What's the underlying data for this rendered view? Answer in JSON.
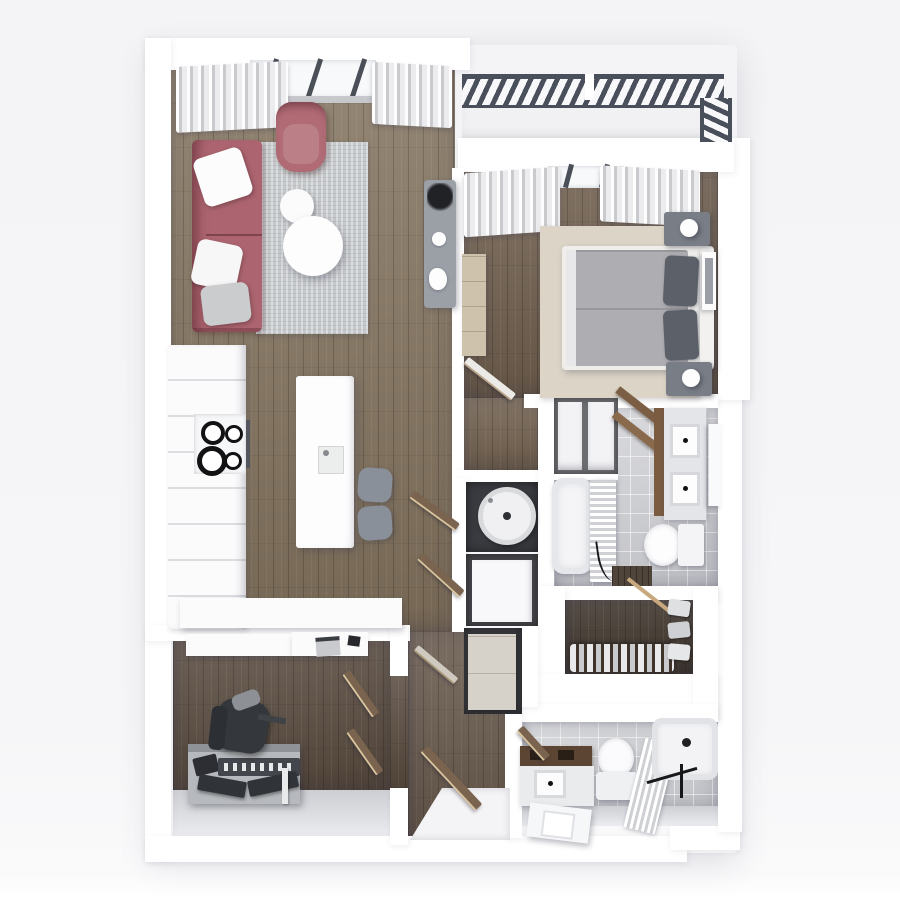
{
  "scene": {
    "type": "3d-floor-plan-rendering",
    "view": "top-down",
    "label": "Apartment floor plan 3D render, one bedroom with den, two bathrooms and balcony"
  },
  "palette": {
    "wall": "#ffffff",
    "bg": "#f5f5f7",
    "wood-main": "#84745f",
    "wood-bedroom": "#6d5c4b",
    "wood-hall": "#71604e",
    "wood-corridor": "#66574a",
    "wood-office": "#57493d",
    "wood-closet": "#3e342b",
    "tile": "#d2d3d6",
    "railing": "#4a4f5c",
    "sofa": "#ac6570",
    "armchair": "#b06b75",
    "rug-living": "#c6c9cb",
    "rug-bedroom": "#dcd5c7",
    "duvet": "#aeaeb2",
    "pillow-dark": "#5c6169",
    "console": "#9ba0a7",
    "stool": "#8a9099",
    "cabinet-white": "#fbfbfc",
    "curtain-shade": "#c9cacd",
    "door-wood": "#7a6450",
    "wood-furniture": "#7c5e44",
    "vanity-wood": "#5c4533",
    "niche-dark": "#3a3b40",
    "beige-cabinet": "#d6d2c9",
    "dresser": "#cfc2ac",
    "fixture-black": "#17181a",
    "chair-dark": "#34373c",
    "desk-gray": "#b6b9bd"
  },
  "rooms": {
    "living": {
      "label": "Living room"
    },
    "kitchen": {
      "label": "Kitchen"
    },
    "bedroom": {
      "label": "Bedroom"
    },
    "balcony": {
      "label": "Balcony"
    },
    "bath_main": {
      "label": "Main bathroom"
    },
    "bath_2": {
      "label": "Second bathroom"
    },
    "office": {
      "label": "Office / den"
    },
    "closet": {
      "label": "Walk-in closet"
    },
    "linen": {
      "label": "Linen closet"
    },
    "laundry": {
      "label": "Laundry / storage niches"
    },
    "hall": {
      "label": "Hallway"
    },
    "entry": {
      "label": "Entry"
    }
  },
  "furniture": {
    "living": [
      "curtains",
      "window",
      "sofa with pillows",
      "armchair",
      "area rug",
      "two round coffee tables",
      "console table with plant"
    ],
    "kitchen": [
      "cabinet run with cooktop",
      "island with sink",
      "two stools",
      "south counter"
    ],
    "bedroom": [
      "curtains",
      "area rug",
      "double bed with dark pillows",
      "two nightstands with lamps",
      "dresser",
      "wall art",
      "open door"
    ],
    "bath_main": [
      "double vanity",
      "leaning mirror",
      "toilet",
      "bathtub",
      "shower curtain",
      "wood shelves",
      "floor mat"
    ],
    "bath_2": [
      "wood-top vanity with sink",
      "leaning mirror",
      "toilet",
      "bathtub",
      "shower curtain",
      "black shower fixtures"
    ],
    "office": [
      "floating shelves with laptop",
      "desk with keyboards and tablet",
      "task chair",
      "double doors"
    ],
    "closet": [
      "hanging clothes",
      "clothes rod",
      "folded items"
    ],
    "laundry": [
      "washing machine",
      "white cabinet",
      "beige storage cabinet",
      "bifold doors"
    ],
    "balcony": [
      "metal railing"
    ]
  }
}
